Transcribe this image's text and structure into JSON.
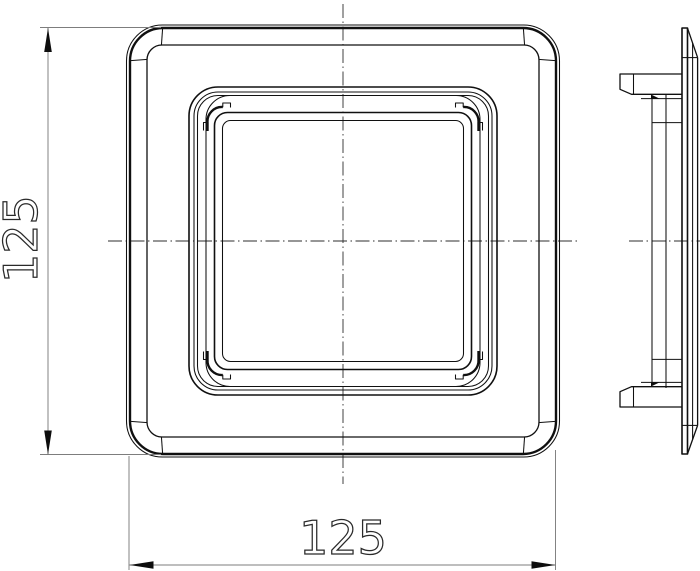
{
  "drawing": {
    "title": "square cover plate - technical drawing",
    "part": "square bezel / cover cap with rounded corners and rear snap tabs",
    "background": "#ffffff",
    "line_color": "#101010",
    "views": [
      {
        "id": "front",
        "name": "front-view"
      },
      {
        "id": "side",
        "name": "side-view"
      }
    ],
    "dimensions": [
      {
        "id": "height",
        "label": "125",
        "orientation": "vertical",
        "applies_to": "front-view overall height"
      },
      {
        "id": "width",
        "label": "125",
        "orientation": "horizontal",
        "applies_to": "front-view overall width"
      }
    ]
  }
}
